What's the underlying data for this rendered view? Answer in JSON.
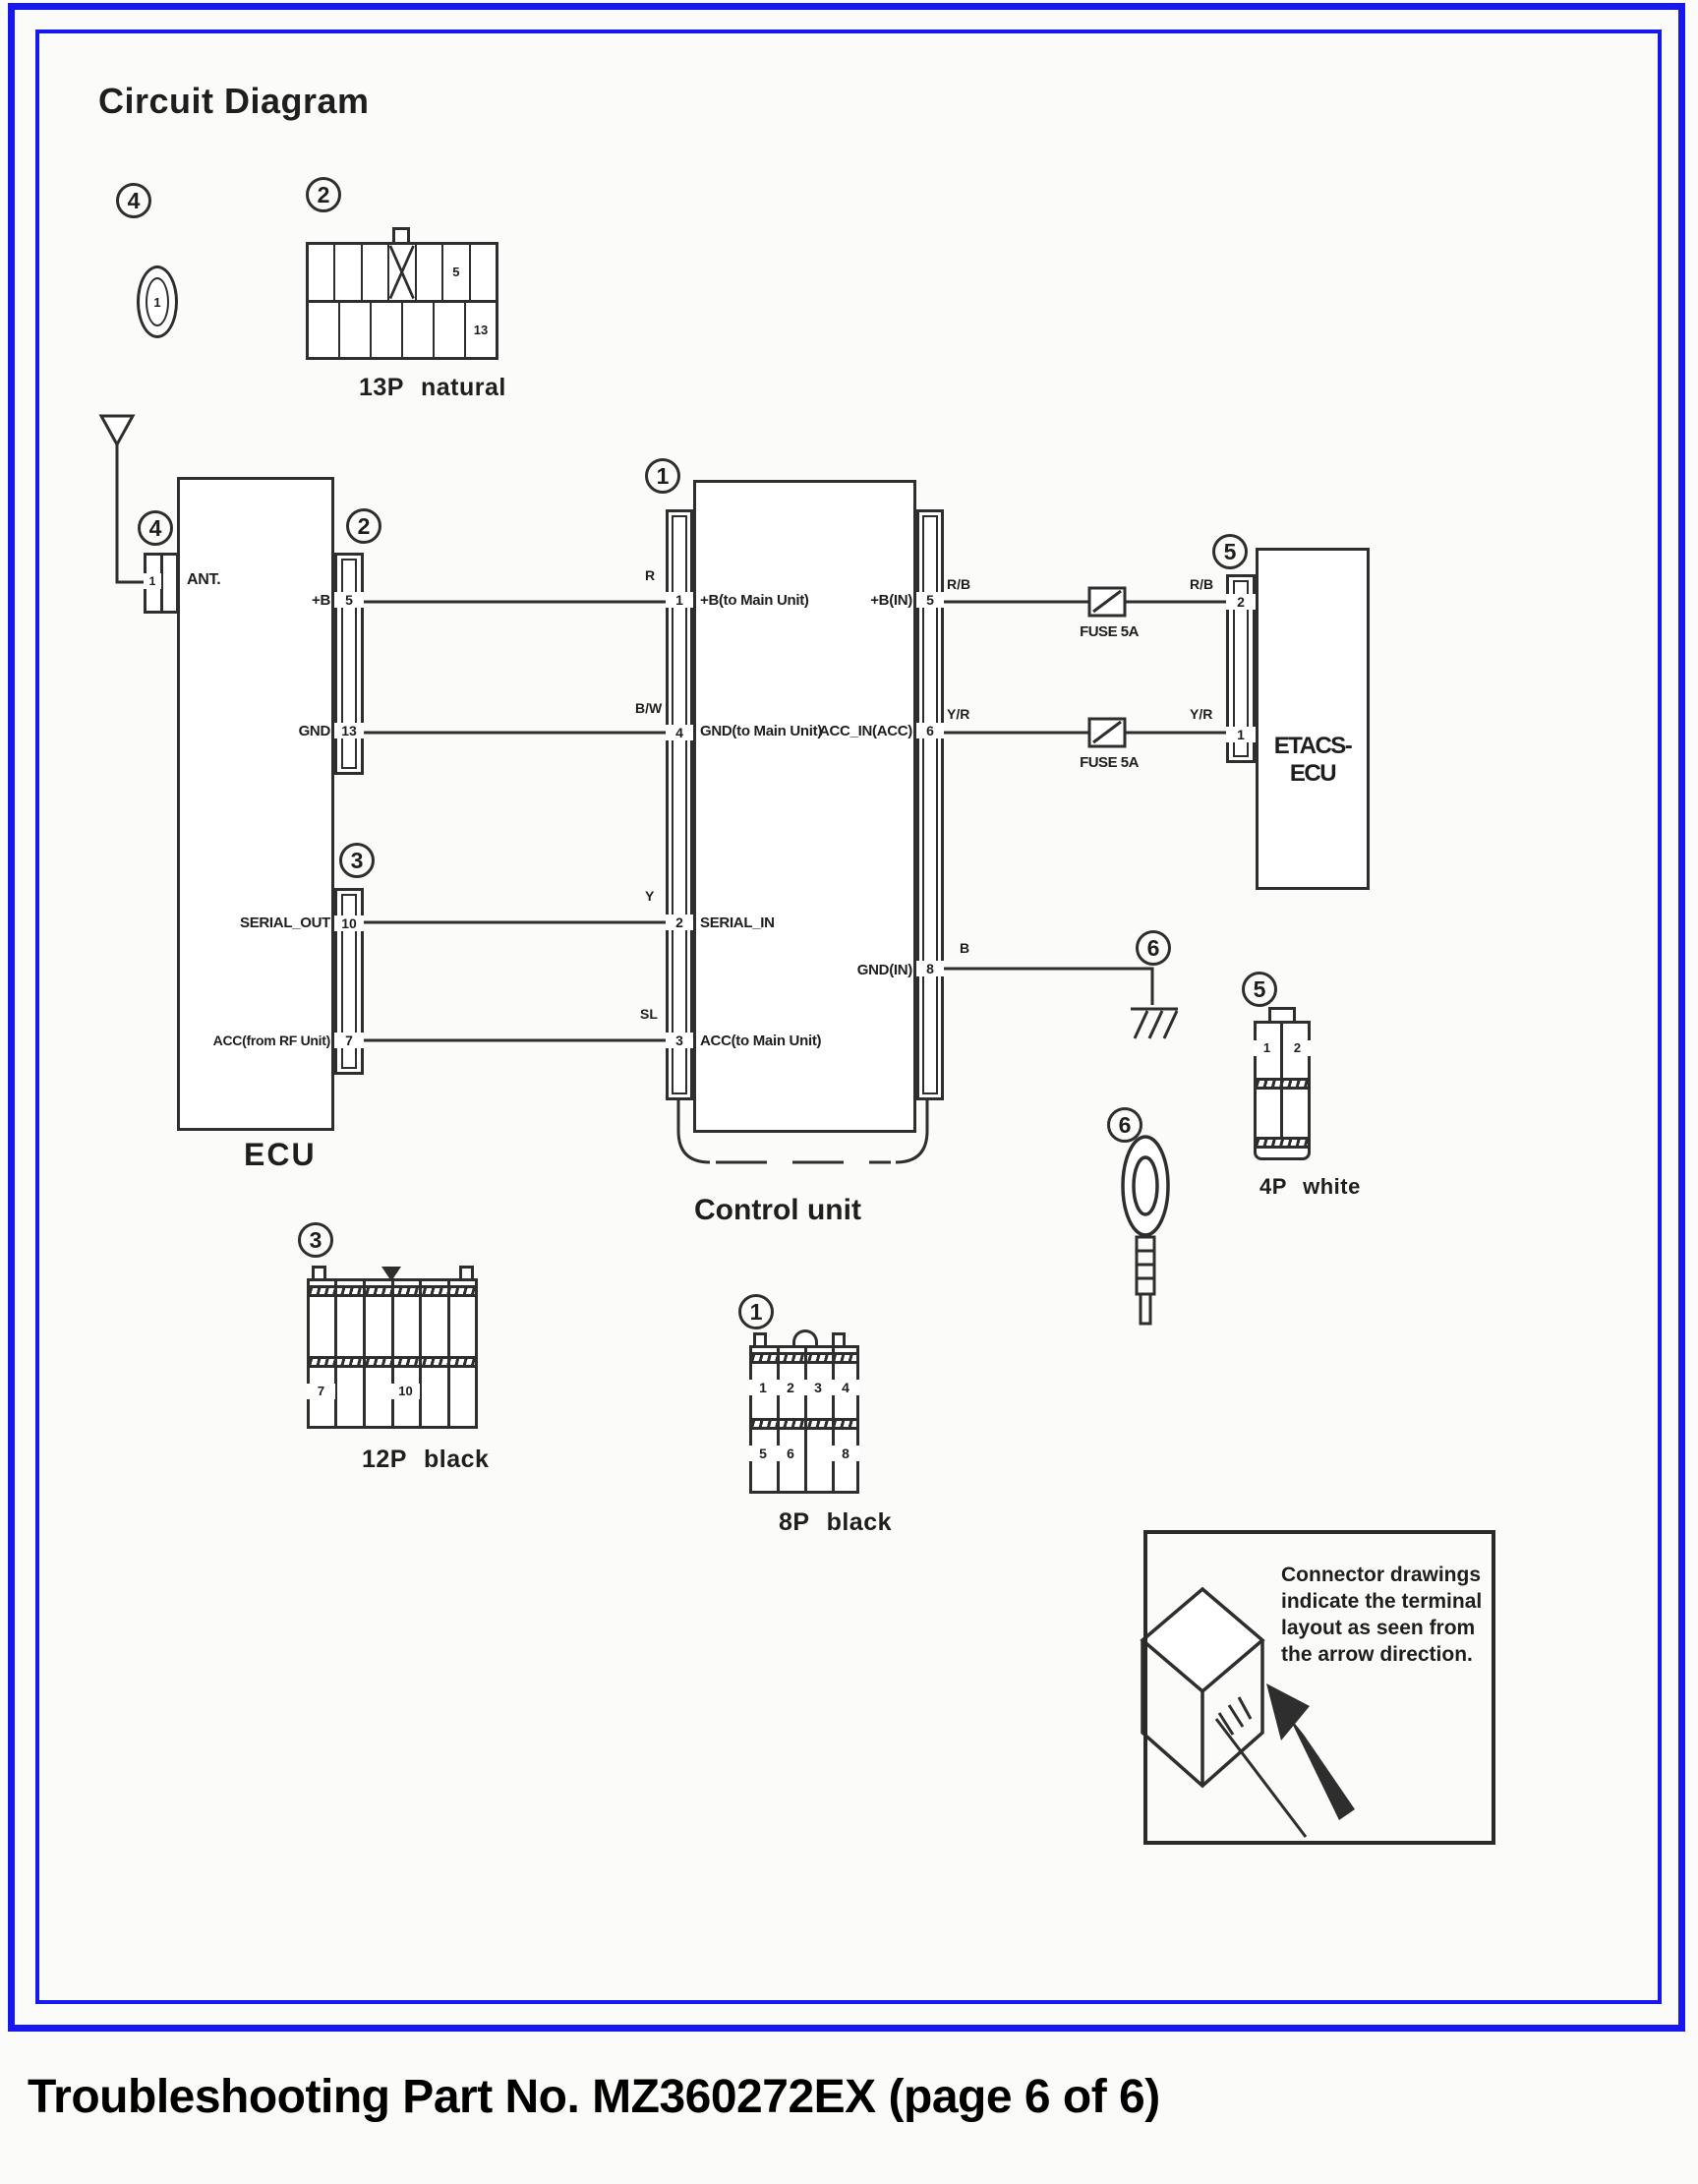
{
  "page": {
    "title": "Circuit Diagram",
    "footer": "Troubleshooting Part No. MZ360272EX (page 6 of 6)"
  },
  "colors": {
    "border_blue": "#1717ef",
    "ink": "#2e2e2e"
  },
  "callouts": {
    "item4_top": "4",
    "item2_top": "2",
    "item4_ant": "4",
    "item2_ecu": "2",
    "item3_ecu": "3",
    "item1_cu": "1",
    "item5_etacs": "5",
    "item6_gnd": "6",
    "item5_4p": "5",
    "item6_ring": "6",
    "item3_12p": "3",
    "item1_8p": "1"
  },
  "connector_oval": {
    "pin": "1"
  },
  "connector_13p": {
    "caption": "13P natural",
    "pin_top": "5",
    "pin_bottom": "13"
  },
  "ecu": {
    "label": "ECU",
    "ant_label": "ANT.",
    "ant_pin": "1",
    "signals": [
      {
        "name": "+B",
        "pin": "5"
      },
      {
        "name": "GND",
        "pin": "13"
      },
      {
        "name": "SERIAL_OUT",
        "pin": "10"
      },
      {
        "name": "ACC(from RF Unit)",
        "pin": "7"
      }
    ]
  },
  "control_unit": {
    "label": "Control unit",
    "left": [
      {
        "wire": "R",
        "pin": "1",
        "signal": "+B(to Main Unit)"
      },
      {
        "wire": "B/W",
        "pin": "4",
        "signal": "GND(to Main Unit)"
      },
      {
        "wire": "Y",
        "pin": "2",
        "signal": "SERIAL_IN"
      },
      {
        "wire": "SL",
        "pin": "3",
        "signal": "ACC(to Main Unit)"
      }
    ],
    "right": [
      {
        "signal": "+B(IN)",
        "pin": "5",
        "wire": "R/B"
      },
      {
        "signal": "ACC_IN(ACC)",
        "pin": "6",
        "wire": "Y/R"
      },
      {
        "signal": "GND(IN)",
        "pin": "8",
        "wire": "B"
      }
    ]
  },
  "fuses": {
    "label": "FUSE 5A"
  },
  "etacs": {
    "label": "ETACS-ECU",
    "pin_top": "2",
    "pin_bottom": "1",
    "wire_top": "R/B",
    "wire_bottom": "Y/R"
  },
  "connector_4p": {
    "caption": "4P white",
    "pins": [
      "1",
      "2"
    ]
  },
  "connector_12p": {
    "caption": "12P black",
    "pin_a": "7",
    "pin_b": "10"
  },
  "connector_8p": {
    "caption": "8P black",
    "top": [
      "1",
      "2",
      "3",
      "4"
    ],
    "bottom": [
      "5",
      "6",
      "",
      "8"
    ]
  },
  "note": {
    "text": "Connector drawings indicate the terminal layout as seen from the arrow direction."
  }
}
